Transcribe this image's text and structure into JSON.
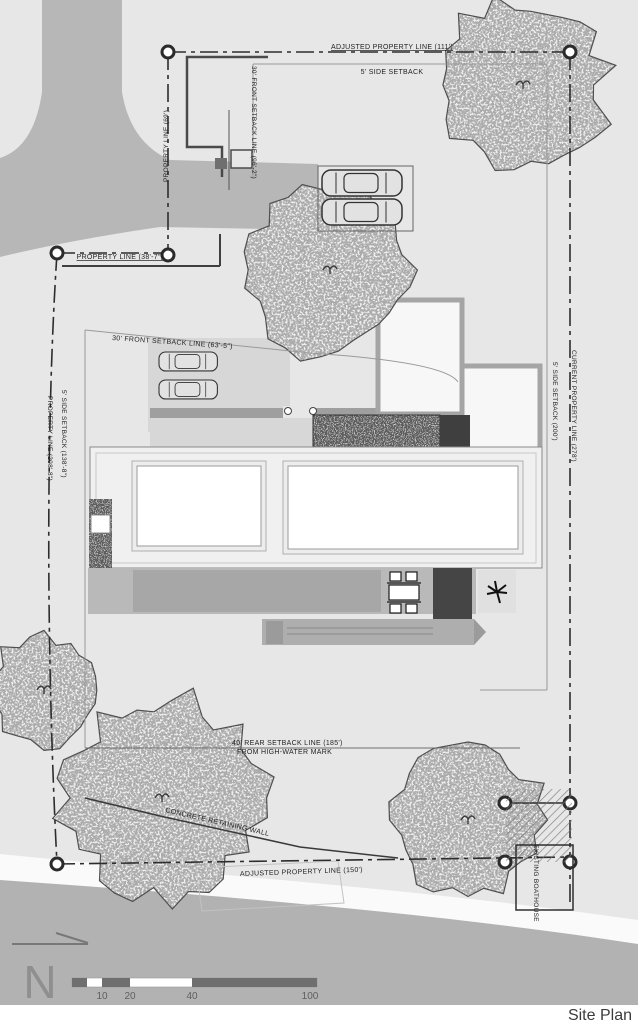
{
  "title": "Site Plan",
  "north": {
    "letter": "N"
  },
  "scale_bar": {
    "ticks": [
      "10",
      "20",
      "40",
      "100"
    ]
  },
  "labels": {
    "adjusted_top": "ADJUSTED PROPERTY LINE (111')",
    "side_setback_top": "5' SIDE SETBACK",
    "front_setback_96": "30' FRONT SETBACK LINE (96'-2\")",
    "property_line_69": "PROPERTY LINE (69')",
    "property_line_38": "PROPERTY LINE (38'-7\")",
    "front_setback_63": "30' FRONT SETBACK LINE (63'-5\")",
    "current_property_line": "CURRENT PROPERTY LINE (278')",
    "side_setback_200": "5' SIDE SETBACK (200')",
    "side_setback_138": "5' SIDE SETBACK (138'-8\")",
    "property_line_208": "PROPERTY LINE (208'-8\")",
    "rear_setback": "40' REAR SETBACK LINE (185')",
    "high_water": "FROM HIGH-WATER MARK",
    "concrete_wall": "CONCRETE RETAINING WALL",
    "adjusted_bottom": "ADJUSTED PROPERTY LINE (150')",
    "boathouse": "EXISTING BOATHOUSE"
  },
  "colors": {
    "plan_bg": "#e7e7e7",
    "road": "#b7b7b7",
    "water": "#b2b2b2",
    "line": "#2d2d2d",
    "accent_dark": "#3f3f3f"
  }
}
